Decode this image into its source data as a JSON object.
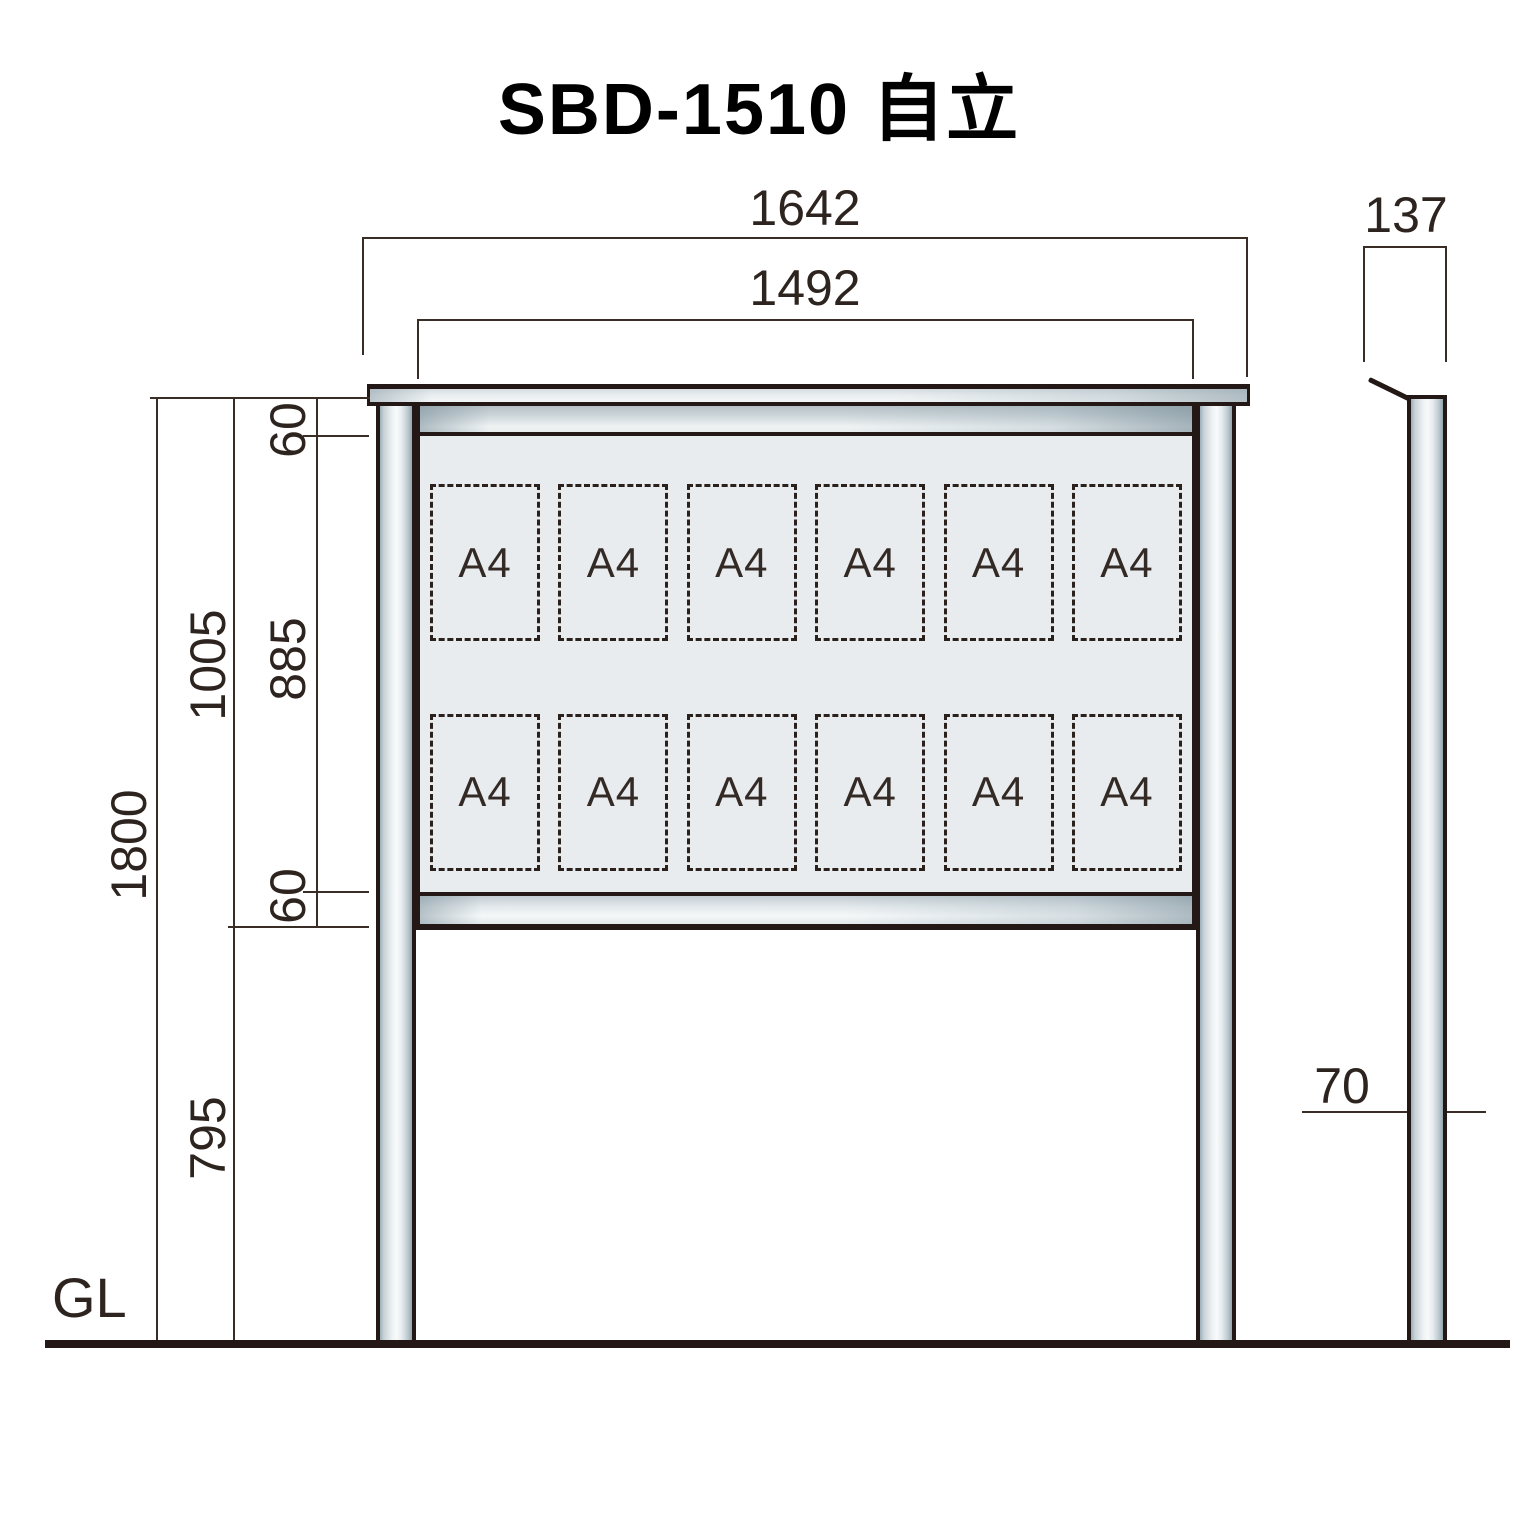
{
  "title": "SBD-1510 自立",
  "front": {
    "width_overall": "1642",
    "width_board": "1492",
    "height_overall": "1800",
    "height_board": "1005",
    "frame_top": "60",
    "opening_height": "885",
    "frame_bottom": "60",
    "leg_height": "795",
    "ground_label": "GL",
    "slot_label": "A4",
    "slot_rows": 2,
    "slot_cols": 6
  },
  "side": {
    "depth": "137",
    "pole_width": "70"
  },
  "colors": {
    "outline": "#231815",
    "dimension_line": "#3a2d26",
    "panel_fill": "#e8ecee",
    "metal_dark": "#9cafb9",
    "metal_light": "#f8fafb",
    "background": "#ffffff"
  }
}
